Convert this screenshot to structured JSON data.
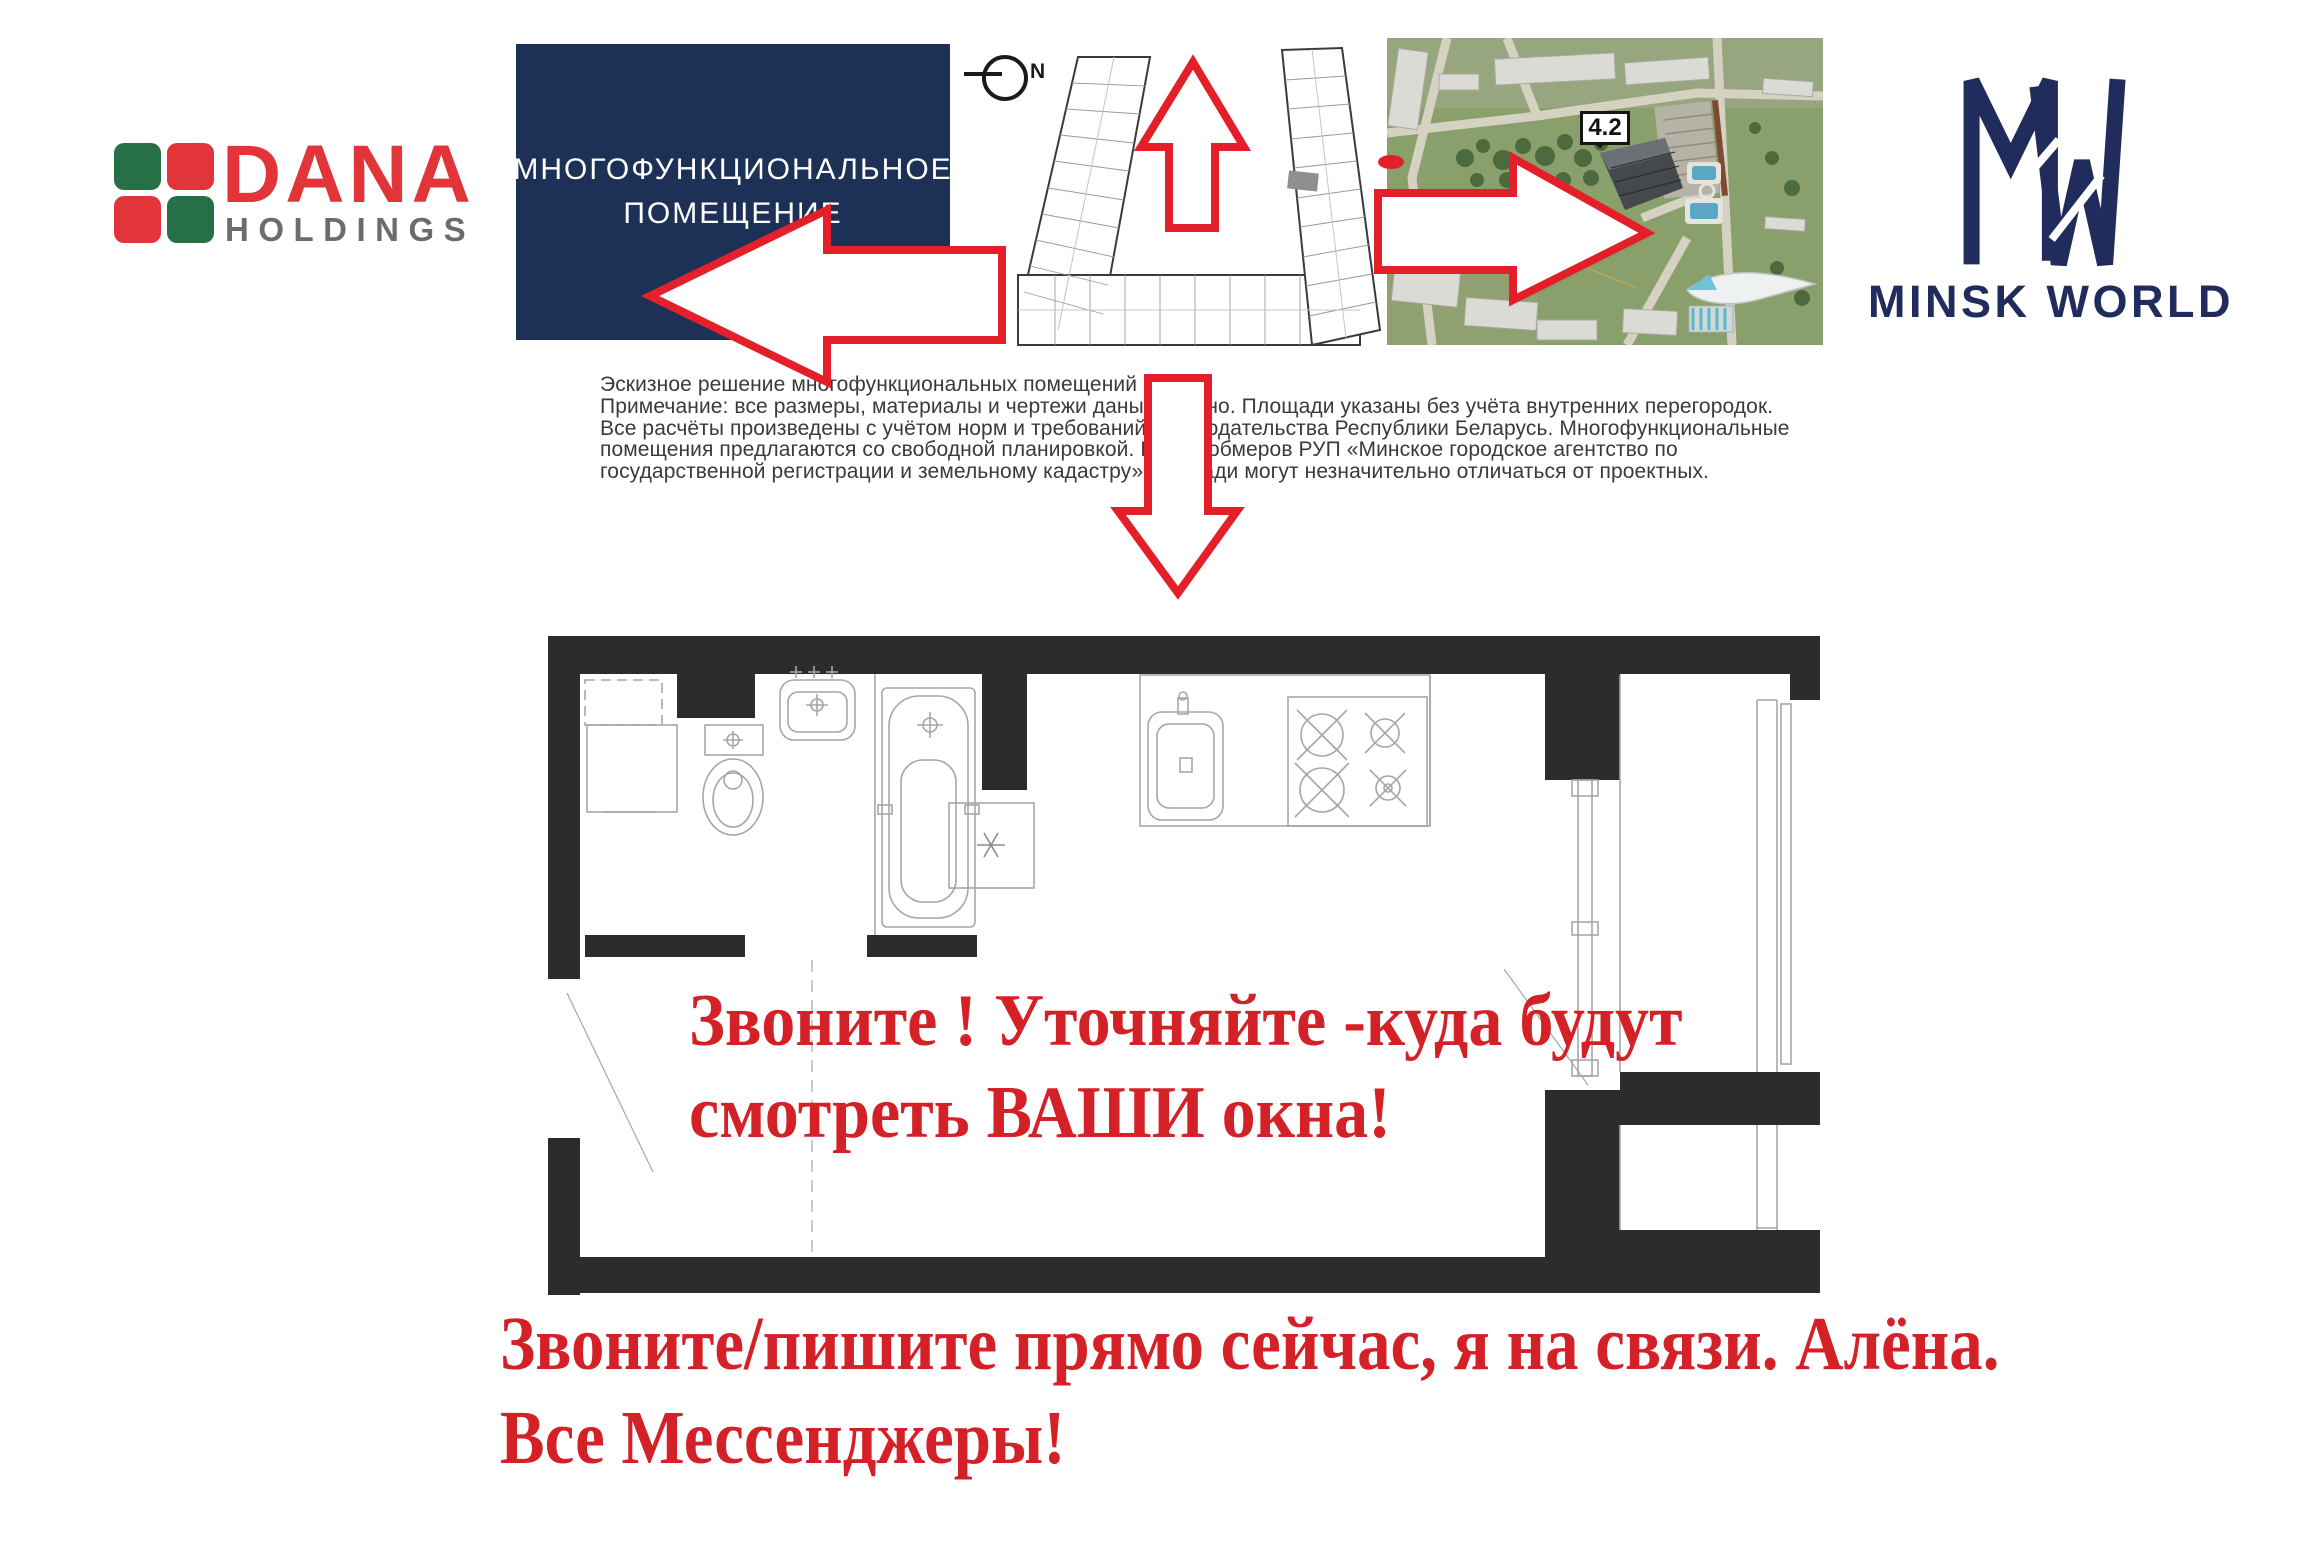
{
  "colors": {
    "arrow_red": "#e3202a",
    "accent_text_red": "#d42127",
    "navy_box": "#1d3157",
    "mw_navy": "#202c5c",
    "dana_red": "#e23539",
    "dana_green": "#276f47",
    "holdings_gray": "#6a6c6e",
    "wall_black": "#2d2c2b",
    "plan_line_gray": "#a6a6a6"
  },
  "branding": {
    "dana": {
      "wordmark": "DANA",
      "subtitle": "HOLDINGS"
    },
    "minsk_world": {
      "wordmark": "MINSK WORLD"
    }
  },
  "banner": {
    "line1": "МНОГОФУНКЦИОНАЛЬНОЕ",
    "line2": "ПОМЕЩЕНИЕ"
  },
  "site_plan": {
    "compass_label": "N"
  },
  "aerial_photo": {
    "building_label": "4.2"
  },
  "arrows": [
    "left",
    "up",
    "right",
    "down"
  ],
  "disclaimer": {
    "lines": [
      "Эскизное решение многофункциональных помещений",
      "Примечание: все размеры, материалы и чертежи даны условно. Площади указаны без учёта внутренних перегородок.",
      "Все расчёты произведены с учётом норм и требований законодательства Республики Беларусь. Многофункциональные",
      "помещения предлагаются со свободной планировкой. После обмеров РУП «Минское городское агентство по",
      "государственной регистрации и земельному кадастру» площади могут незначительно отличаться от проектных."
    ]
  },
  "floor_plan_note": {
    "line1": "Звоните ! Уточняйте -куда будут",
    "line2": "смотреть ВАШИ окна!"
  },
  "contact_note": {
    "line1": "Звоните/пишите прямо сейчас, я на связи. Алёна.",
    "line2": "Все Мессенджеры!"
  }
}
